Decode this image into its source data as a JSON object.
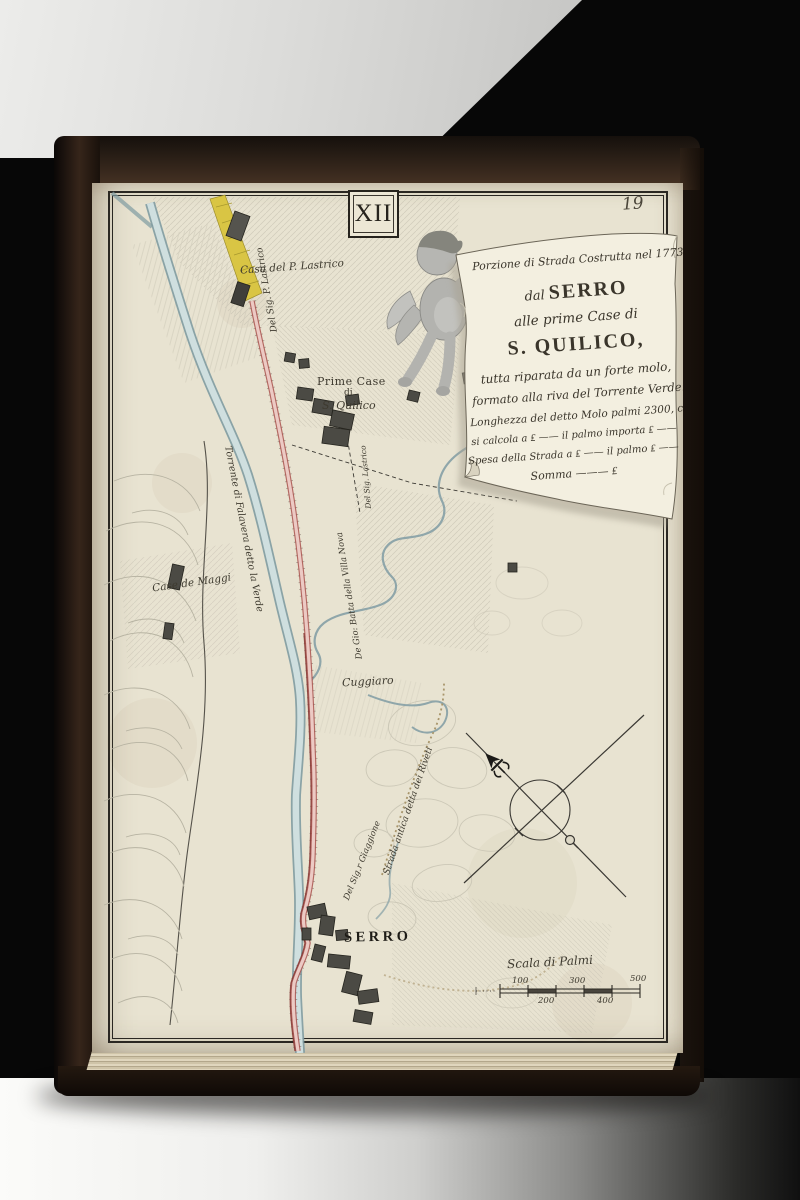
{
  "page": {
    "plate_number": "XII",
    "page_number": "19"
  },
  "cartouche": {
    "line1": "Porzione di Strada Costrutta nel 1773",
    "line2_prefix": "dal ",
    "line2_main": "SERRO",
    "line3": "alle prime Case di",
    "line4": "S. QUILICO,",
    "line5": "tutta riparata da un forte molo,",
    "line6": "formato alla riva del Torrente Verde.",
    "line7": "Longhezza del detto Molo palmi 2300, che",
    "line8": "si calcola a ₤ —— il palmo importa ₤ ——",
    "line9": "Spesa della Strada a ₤ —— il palmo ₤ ——",
    "line10": "Somma ——— ₤"
  },
  "map_labels": {
    "casa_lastrico": "Casa del P. Lastrico",
    "road_owner_top": "Del Sig. P. Lastrico",
    "prime_case_line1": "Prime Case",
    "prime_case_line2": "di",
    "prime_case_line3": "S. Quilico",
    "case_maggi": "Case de Maggi",
    "torrente": "Torrente di Falavera detto la Verde",
    "villa_nova": "De Gio: Batta della Villa Nova",
    "cuggiaro": "Cuggiaro",
    "strada_antica": "Strada antica detta dei Riveti",
    "giaggione": "Del Sig.r Giaggione",
    "owner_small": "Del Sig. Lastrico",
    "serro": "SERRO"
  },
  "scale_bar": {
    "title": "Scala di Palmi",
    "labels_above": [
      "100",
      "300",
      "500"
    ],
    "labels_below": [
      "200",
      "400"
    ]
  },
  "icons": {
    "north": "fleur-de-lis-icon",
    "south_marker": "circle-marker-icon"
  },
  "colors": {
    "paper": "#e8e3d1",
    "ink": "#3a352b",
    "river_fill": "#cfdfdf",
    "river_edge": "#7f9ba1",
    "road_fill": "#eccac4",
    "road_edge": "#a9524e",
    "road_dark": "#8a3a36",
    "highlight_yellow": "#d9c544",
    "building": "#4b4a44",
    "hill_stroke": "#b7b3a2"
  }
}
